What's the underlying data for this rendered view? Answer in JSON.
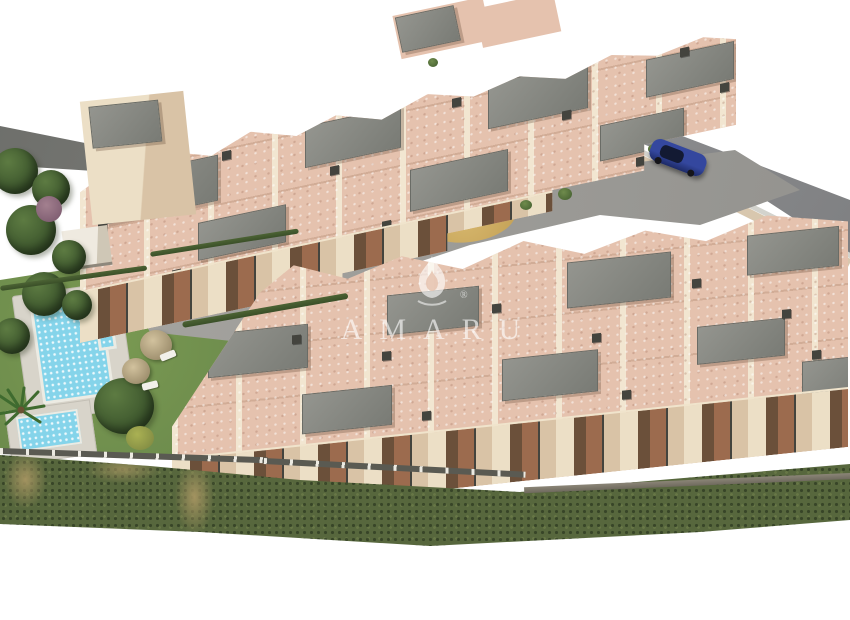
{
  "image": {
    "type": "architectural-aerial-render",
    "description": "Aerial 3D rendering of a Mediterranean hillside apartment complex with communal pool, gardens, playground and street, isolated on a white background"
  },
  "watermark": {
    "brand": "AMARU",
    "registered_mark": "®",
    "icon": "flame-icon",
    "color": "#ffffff",
    "style": "translucent white serif capitals with wide letter spacing, flame logo above"
  },
  "palette": {
    "background": "#ffffff",
    "wall_light": "#ecdfc6",
    "wall_mid": "#d9c3a6",
    "terrace": "#e5c2ae",
    "roof_gray": "#94958f",
    "roof_dark": "#797b75",
    "street_gray": "#87888a",
    "road_dark": "#6e6f6b",
    "path_gray": "#9d9c98",
    "lawn_green": "#7a9a52",
    "lawn_dark": "#67854a",
    "scrub_green": "#57673d",
    "scrub_dry": "#a39360",
    "pool_water": "#85d4ea",
    "pool_deck": "#d8d4ca",
    "sand": "#d8b96f",
    "play_wood": "#8a6a42",
    "car_blue": "#34479e",
    "car_window": "#131a33",
    "balcony_wood": "#9c6b4e",
    "balcony_shadow": "#6b503a",
    "railing_dark": "#44443e",
    "tree_green": "#5d7b42",
    "tree_dark": "#38512a",
    "parasol_tan": "#d2c29e",
    "fence_light": "#eceae2"
  },
  "scene": {
    "elements": [
      {
        "name": "building-cluster-north",
        "desc": "Upper zigzag row of beige apartment blocks with pink-tiled roof terraces, gray flat roofs, chimneys and stepped balconies"
      },
      {
        "name": "building-cluster-south",
        "desc": "Lower zigzag row of apartment blocks with large ground-floor terraces above the slope"
      },
      {
        "name": "swimming-pool",
        "desc": "Rectangular communal pool with pale blue water on a light deck"
      },
      {
        "name": "kids-pool",
        "desc": "Small children's pool beside the main pool"
      },
      {
        "name": "lawn",
        "desc": "Green communal lawn with two tan parasols, sun loungers and trees"
      },
      {
        "name": "playground",
        "desc": "Oval sand playground with a wooden play structure in the central courtyard"
      },
      {
        "name": "courtyard-path",
        "desc": "Gray paved paths and courtyard between the two building rows"
      },
      {
        "name": "street-top-right",
        "desc": "Gray street along the upper-right boundary"
      },
      {
        "name": "blue-car",
        "desc": "Dark blue hatchback parked on the street"
      },
      {
        "name": "access-road-top-left",
        "desc": "Dark asphalt access road along the upper-left boundary"
      },
      {
        "name": "scrubland",
        "desc": "Band of wild green and dry scrub vegetation along the bottom slope"
      },
      {
        "name": "perimeter-fence",
        "desc": "Fence with light posts between gardens and scrubland"
      },
      {
        "name": "pool-house",
        "desc": "Small white flat-roofed utility building near the pool"
      },
      {
        "name": "palm-tree",
        "desc": "Palm tree at the left edge of the garden"
      }
    ]
  }
}
